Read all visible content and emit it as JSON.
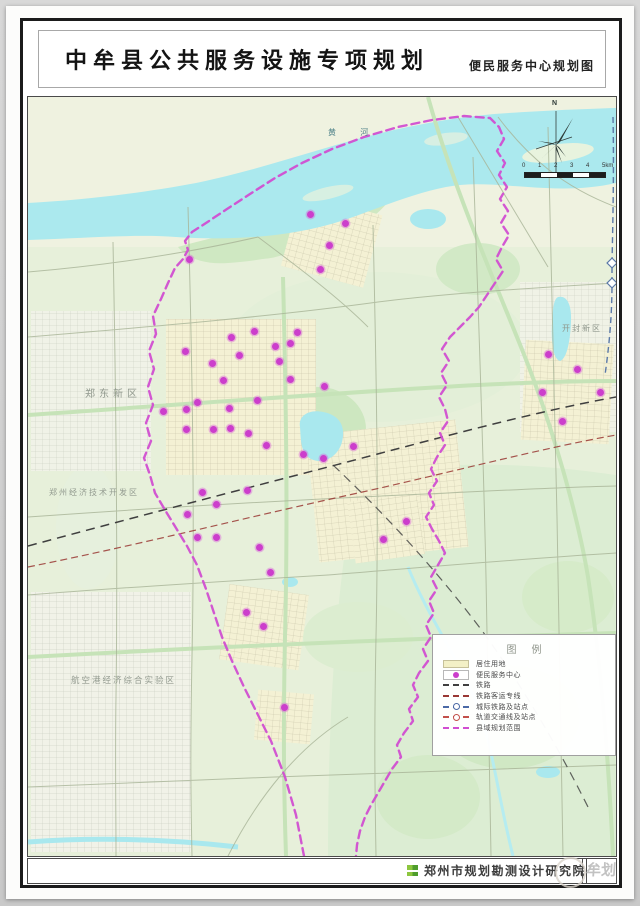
{
  "page_title": {
    "main": "中牟县公共服务设施专项规划",
    "sub": "便民服务中心规划图"
  },
  "map": {
    "north_label": "N",
    "scale_ticks": [
      "0",
      "1",
      "2",
      "3",
      "4",
      "5km"
    ],
    "region_labels": [
      {
        "text": "黄 河",
        "x": 300,
        "y": 30,
        "size": 8,
        "spacing": 11,
        "color": "#4f8289"
      },
      {
        "text": "郑东新区",
        "x": 57,
        "y": 288,
        "size": 10,
        "spacing": 4,
        "color": "#8f978c"
      },
      {
        "text": "开封新区",
        "x": 534,
        "y": 226,
        "size": 8,
        "spacing": 2,
        "color": "#8f978c"
      },
      {
        "text": "郑州经济技术开发区",
        "x": 21,
        "y": 390,
        "size": 8,
        "spacing": 2,
        "color": "#939b90"
      },
      {
        "text": "航空港经济综合实验区",
        "x": 43,
        "y": 577,
        "size": 8.5,
        "spacing": 2,
        "color": "#939b90"
      }
    ],
    "marker_color": "#cc3ecc",
    "boundary_color": "#d14ed1",
    "markers": [
      [
        282,
        117
      ],
      [
        317,
        126
      ],
      [
        301,
        148
      ],
      [
        292,
        172
      ],
      [
        161,
        162
      ],
      [
        203,
        240
      ],
      [
        226,
        234
      ],
      [
        269,
        235
      ],
      [
        247,
        249
      ],
      [
        262,
        246
      ],
      [
        157,
        254
      ],
      [
        211,
        258
      ],
      [
        184,
        266
      ],
      [
        251,
        264
      ],
      [
        195,
        283
      ],
      [
        262,
        282
      ],
      [
        296,
        289
      ],
      [
        169,
        305
      ],
      [
        229,
        303
      ],
      [
        135,
        314
      ],
      [
        158,
        312
      ],
      [
        201,
        311
      ],
      [
        158,
        332
      ],
      [
        185,
        332
      ],
      [
        202,
        331
      ],
      [
        220,
        336
      ],
      [
        238,
        348
      ],
      [
        275,
        357
      ],
      [
        295,
        361
      ],
      [
        325,
        349
      ],
      [
        174,
        395
      ],
      [
        219,
        393
      ],
      [
        188,
        407
      ],
      [
        159,
        417
      ],
      [
        169,
        440
      ],
      [
        188,
        440
      ],
      [
        231,
        450
      ],
      [
        242,
        475
      ],
      [
        218,
        515
      ],
      [
        235,
        529
      ],
      [
        256,
        610
      ],
      [
        355,
        442
      ],
      [
        378,
        424
      ],
      [
        520,
        257
      ],
      [
        549,
        272
      ],
      [
        514,
        295
      ],
      [
        572,
        295
      ],
      [
        534,
        324
      ]
    ]
  },
  "legend": {
    "title": "图例",
    "items": [
      {
        "label": "居住用地",
        "symbol": "swatch",
        "color": "#f3f0c6"
      },
      {
        "label": "便民服务中心",
        "symbol": "dot",
        "color": "#cc3ecc"
      },
      {
        "label": "铁路",
        "symbol": "dash",
        "color": "#3f3f3f"
      },
      {
        "label": "铁路客运专线",
        "symbol": "dash",
        "color": "#993733"
      },
      {
        "label": "城际铁路及站点",
        "symbol": "dash-dot",
        "color": "#4a69a5"
      },
      {
        "label": "轨道交通线及站点",
        "symbol": "dash-dot",
        "color": "#c2504a"
      },
      {
        "label": "县域规划范围",
        "symbol": "dashes",
        "color": "#d14ed1"
      }
    ]
  },
  "footer": {
    "institute": "郑州市规划勘测设计研究院",
    "watermark": "牟划"
  }
}
